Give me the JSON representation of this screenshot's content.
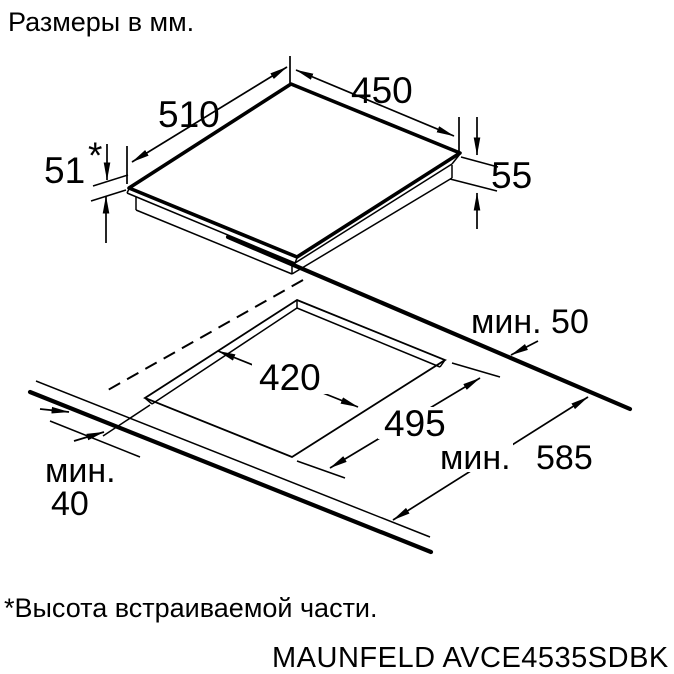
{
  "colors": {
    "background": "#ffffff",
    "ink": "#000000"
  },
  "header": {
    "units_note": "Размеры в мм."
  },
  "hob": {
    "depth": "510",
    "width": "450",
    "built_in_height": "51",
    "built_in_height_star": "*",
    "total_height": "55"
  },
  "cutout": {
    "width": "420",
    "depth": "495",
    "rear_clearance": "мин. 50",
    "counter_depth_prefix": "мин.",
    "counter_depth_value": "585",
    "front_clearance_line1": "мин.",
    "front_clearance_line2": "40"
  },
  "footer": {
    "footnote": "*Высота встраиваемой части.",
    "model": "MAUNFELD AVCE4535SDBK"
  }
}
